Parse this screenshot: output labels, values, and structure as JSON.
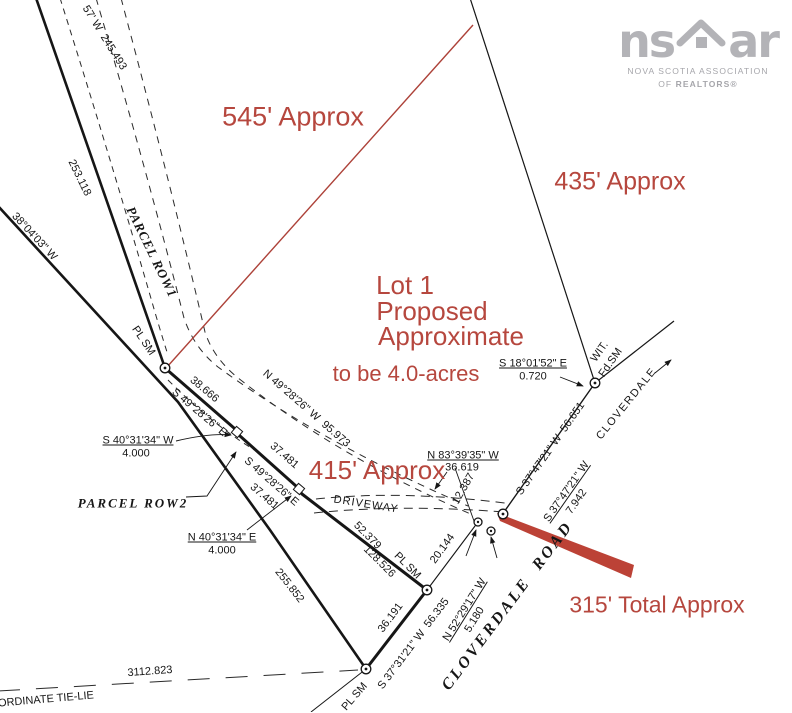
{
  "colors": {
    "ink": "#161616",
    "red": "#b6473e",
    "paper": "#ffffff",
    "logo": "#b3b3b7"
  },
  "logo": {
    "word_left": "ns",
    "word_right": "ar",
    "line1": "NOVA SCOTIA ASSOCIATION",
    "line2_prefix": "OF ",
    "line2_bold": "REALTORS®"
  },
  "plan": {
    "labels": [
      {
        "name": "bearing-top-left",
        "text": "57' W  245.493",
        "x": 104,
        "y": 38,
        "rot": 58
      },
      {
        "name": "dist-253118",
        "text": "253.118",
        "x": 79,
        "y": 178,
        "rot": 64
      },
      {
        "name": "bearing-380403",
        "text": "38°04'03\" W",
        "x": 34,
        "y": 237,
        "rot": 47
      },
      {
        "name": "parcel-row1",
        "text": "PARCEL ROW1",
        "x": 152,
        "y": 252,
        "rot": 64,
        "cls": "serif",
        "fs": 13,
        "ls": 1
      },
      {
        "name": "plsm-1",
        "text": "PL SM",
        "x": 143,
        "y": 341,
        "rot": 56
      },
      {
        "name": "dist-38666",
        "text": "38.666",
        "x": 204,
        "y": 390,
        "rot": 40
      },
      {
        "name": "bearing-s4928-1",
        "text": "S 49°28'26\" E",
        "x": 199,
        "y": 413,
        "rot": 40
      },
      {
        "name": "bearing-n4928",
        "text": "N 49°28'26\" W  95.973",
        "x": 306,
        "y": 409,
        "rot": 41
      },
      {
        "name": "dist-37481-a",
        "text": "37.481",
        "x": 284,
        "y": 456,
        "rot": 41
      },
      {
        "name": "bearing-s4928-2",
        "text": "S 49°28'26\" E",
        "x": 271,
        "y": 482,
        "rot": 41
      },
      {
        "name": "dist-37481-b",
        "text": "37.481",
        "x": 264,
        "y": 497,
        "rot": 41
      },
      {
        "name": "bearing-s4031",
        "text": "S 40°31'34\" W",
        "x": 138,
        "y": 441,
        "u": 1
      },
      {
        "name": "dist-4000-a",
        "text": "4.000",
        "x": 136,
        "y": 454
      },
      {
        "name": "parcel-row2",
        "text": "PARCEL ROW2",
        "x": 133,
        "y": 503,
        "cls": "serif",
        "fs": 13,
        "ls": 2
      },
      {
        "name": "bearing-n4031",
        "text": "N 40°31'34\" E",
        "x": 222,
        "y": 538,
        "u": 1
      },
      {
        "name": "dist-4000-b",
        "text": "4.000",
        "x": 222,
        "y": 551
      },
      {
        "name": "bearing-n8339",
        "text": "N 83°39'35\" W",
        "x": 463,
        "y": 456,
        "u": 1
      },
      {
        "name": "dist-36619",
        "text": "36.619",
        "x": 462,
        "y": 468
      },
      {
        "name": "dist-12387",
        "text": "12.387",
        "x": 464,
        "y": 489,
        "rot": -60
      },
      {
        "name": "driveway",
        "text": "DRIVEWAY",
        "x": 366,
        "y": 505,
        "rot": 9,
        "ls": 1
      },
      {
        "name": "dist-52379",
        "text": "52.379",
        "x": 367,
        "y": 536,
        "rot": 45
      },
      {
        "name": "dist-128526",
        "text": "128.526",
        "x": 379,
        "y": 562,
        "rot": 45
      },
      {
        "name": "plsm-2",
        "text": "PL SM",
        "x": 407,
        "y": 566,
        "rot": 45
      },
      {
        "name": "dist-20144",
        "text": "20.144",
        "x": 443,
        "y": 549,
        "rot": -54
      },
      {
        "name": "dist-36191",
        "text": "36.191",
        "x": 391,
        "y": 618,
        "rot": -53
      },
      {
        "name": "bearing-s3731",
        "text": "S 37°31'21\" W  56.335",
        "x": 414,
        "y": 644,
        "rot": -53
      },
      {
        "name": "dist-255852",
        "text": "255.852",
        "x": 289,
        "y": 586,
        "rot": 52
      },
      {
        "name": "dist-3112823",
        "text": "3112.823",
        "x": 150,
        "y": 672,
        "rot": -4
      },
      {
        "name": "tie-line-label",
        "text": "ORDINATE TIE-LIE",
        "x": 46,
        "y": 700,
        "rot": -5
      },
      {
        "name": "plsm-3",
        "text": "PL SM",
        "x": 355,
        "y": 697,
        "rot": -49
      },
      {
        "name": "bearing-s1801",
        "text": "S 18°01'52\" E",
        "x": 533,
        "y": 364,
        "u": 1
      },
      {
        "name": "dist-0720",
        "text": "0.720",
        "x": 533,
        "y": 377
      },
      {
        "name": "wit",
        "text": "WIT.",
        "x": 600,
        "y": 352,
        "rot": -55
      },
      {
        "name": "fdsm",
        "text": "Fd.SM",
        "x": 611,
        "y": 363,
        "rot": -55
      },
      {
        "name": "bearing-s3747-long",
        "text": "S 37°47'21\" W  56.651",
        "x": 551,
        "y": 449,
        "rot": -55
      },
      {
        "name": "bearing-s3747-short",
        "text": "S 37°47'21\" W",
        "x": 567,
        "y": 492,
        "rot": -55,
        "u": 1
      },
      {
        "name": "dist-7942",
        "text": "7.942",
        "x": 577,
        "y": 502,
        "rot": -55
      },
      {
        "name": "bearing-n5229",
        "text": "N 52°29'17\" W",
        "x": 465,
        "y": 610,
        "rot": -58,
        "u": 1
      },
      {
        "name": "dist-5180",
        "text": "5.180",
        "x": 475,
        "y": 620,
        "rot": -58
      },
      {
        "name": "cloverdale",
        "text": "CLOVERDALE",
        "x": 627,
        "y": 404,
        "rot": -51,
        "ls": 1.5
      },
      {
        "name": "cloverdale-road",
        "text": "CLOVERDALE  ROAD",
        "x": 508,
        "y": 606,
        "rot": -53,
        "cls": "serif",
        "fs": 16,
        "ls": 3
      },
      {
        "name": "anno-545",
        "text": "545' Approx",
        "x": 293,
        "y": 117,
        "cls": "red",
        "fs": 27
      },
      {
        "name": "anno-435",
        "text": "435' Approx",
        "x": 620,
        "y": 182,
        "cls": "red",
        "fs": 25
      },
      {
        "name": "anno-lot1",
        "text": "Lot 1",
        "x": 405,
        "y": 285,
        "cls": "red",
        "fs": 26
      },
      {
        "name": "anno-proposed",
        "text": "Proposed",
        "x": 432,
        "y": 311,
        "cls": "red",
        "fs": 26
      },
      {
        "name": "anno-approximate",
        "text": "Approximate",
        "x": 451,
        "y": 336,
        "cls": "red",
        "fs": 26
      },
      {
        "name": "anno-acres",
        "text": "to be 4.0-acres",
        "x": 406,
        "y": 374,
        "cls": "red",
        "fs": 22
      },
      {
        "name": "anno-415",
        "text": "415' Approx",
        "x": 377,
        "y": 470,
        "cls": "red",
        "fs": 26
      },
      {
        "name": "anno-315",
        "text": "315' Total Approx",
        "x": 657,
        "y": 605,
        "cls": "red",
        "fs": 23
      }
    ]
  }
}
